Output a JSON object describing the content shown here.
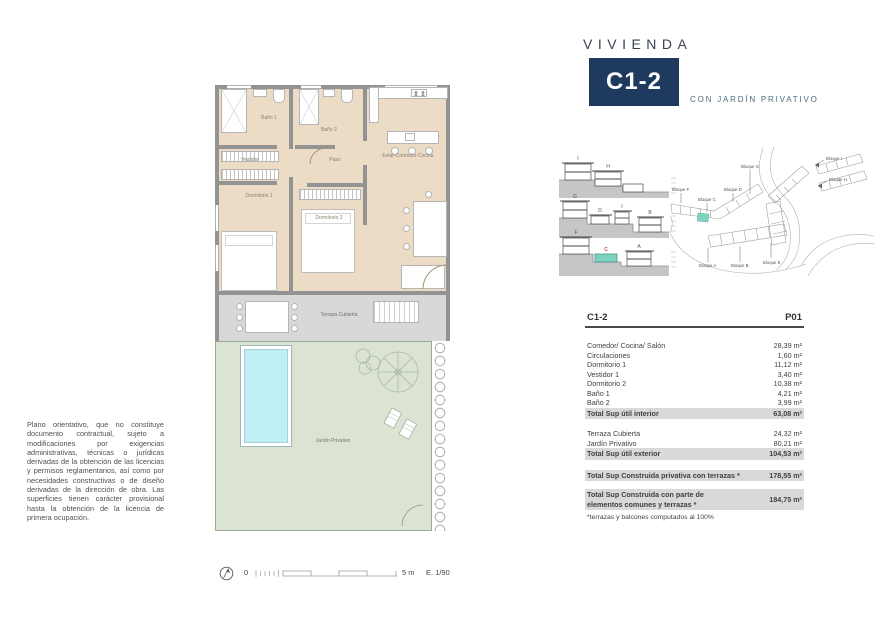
{
  "header": {
    "brand": "VIVIENDA",
    "unit": "C1-2",
    "subtitle": "CON JARDÍN PRIVATIVO"
  },
  "disclaimer": "Plano orientativo, que no constituye documento contractual, sujeto a modificaciones por exigencias administrativas, técnicas o jurídicas derivadas de la obtención de las licencias y permisos reglamentarios, así como por necesidades constructivas o de diseño derivadas de la dirección de obra. Las superficies tienen carácter provisional hasta la obtención de la licencia de primera ocupación.",
  "plan": {
    "rooms": {
      "bano1": "Baño 1",
      "bano2": "Baño 2",
      "paso": "Paso",
      "vestidor": "Vestidor",
      "estar": "Estar-Comedor-Cocina",
      "dormitorio1": "Dormitorio 1",
      "dormitorio2": "Dormitorio 2",
      "terraza": "Terraza Cubierta",
      "jardin": "Jardín Privativo"
    }
  },
  "scale_bar": {
    "zero": "0",
    "length": "5 m",
    "ratio": "E. 1/90"
  },
  "sections": {
    "row1": {
      "letters": [
        "I",
        "H"
      ]
    },
    "row2": {
      "letters": [
        "G",
        "D",
        "I",
        "B"
      ]
    },
    "row3": {
      "letters": [
        "F",
        "C",
        "A"
      ]
    }
  },
  "site_plan": {
    "blocks": [
      "Bloque F",
      "Bloque C",
      "Bloque G",
      "Bloque D",
      "Bloque I",
      "Bloque H",
      "Bloque A",
      "Bloque B",
      "Bloque E"
    ]
  },
  "table": {
    "unit": "C1-2",
    "floor": "P01",
    "rows": [
      {
        "label": "Comedor/ Cocina/ Salón",
        "value": "28,39 m²"
      },
      {
        "label": "Circulaciones",
        "value": "1,60 m²"
      },
      {
        "label": "Dormitorio 1",
        "value": "11,12 m²"
      },
      {
        "label": "Vestidor 1",
        "value": "3,40 m²"
      },
      {
        "label": "Dormitorio 2",
        "value": "10,38 m²"
      },
      {
        "label": "Baño 1",
        "value": "4,21 m²"
      },
      {
        "label": "Baño 2",
        "value": "3,99 m²"
      },
      {
        "label": "Total Sup útil interior",
        "value": "63,08 m²"
      },
      {
        "label": "Terraza Cubierta",
        "value": "24,32 m²"
      },
      {
        "label": "Jardín Privativo",
        "value": "80,21 m²"
      },
      {
        "label": "Total Sup útil exterior",
        "value": "104,53 m²"
      },
      {
        "label": "Total Sup Construida privativa con terrazas *",
        "value": "178,55 m²"
      },
      {
        "label": "Total Sup Construida con parte de elementos comunes y terrazas *",
        "value": "184,75 m²"
      }
    ],
    "footnote": "*terrazas y balcones computados al 100%"
  },
  "colors": {
    "navy": "#1e3a5e",
    "teal_highlight": "#7fd2c0",
    "floor_beige": "#ecdcc5",
    "wall_gray": "#939393",
    "terrace_gray": "#d8d8d8",
    "garden_green": "#dbe4d3",
    "pool_blue": "#bfeef4",
    "table_highlight": "#d9d9d9"
  }
}
